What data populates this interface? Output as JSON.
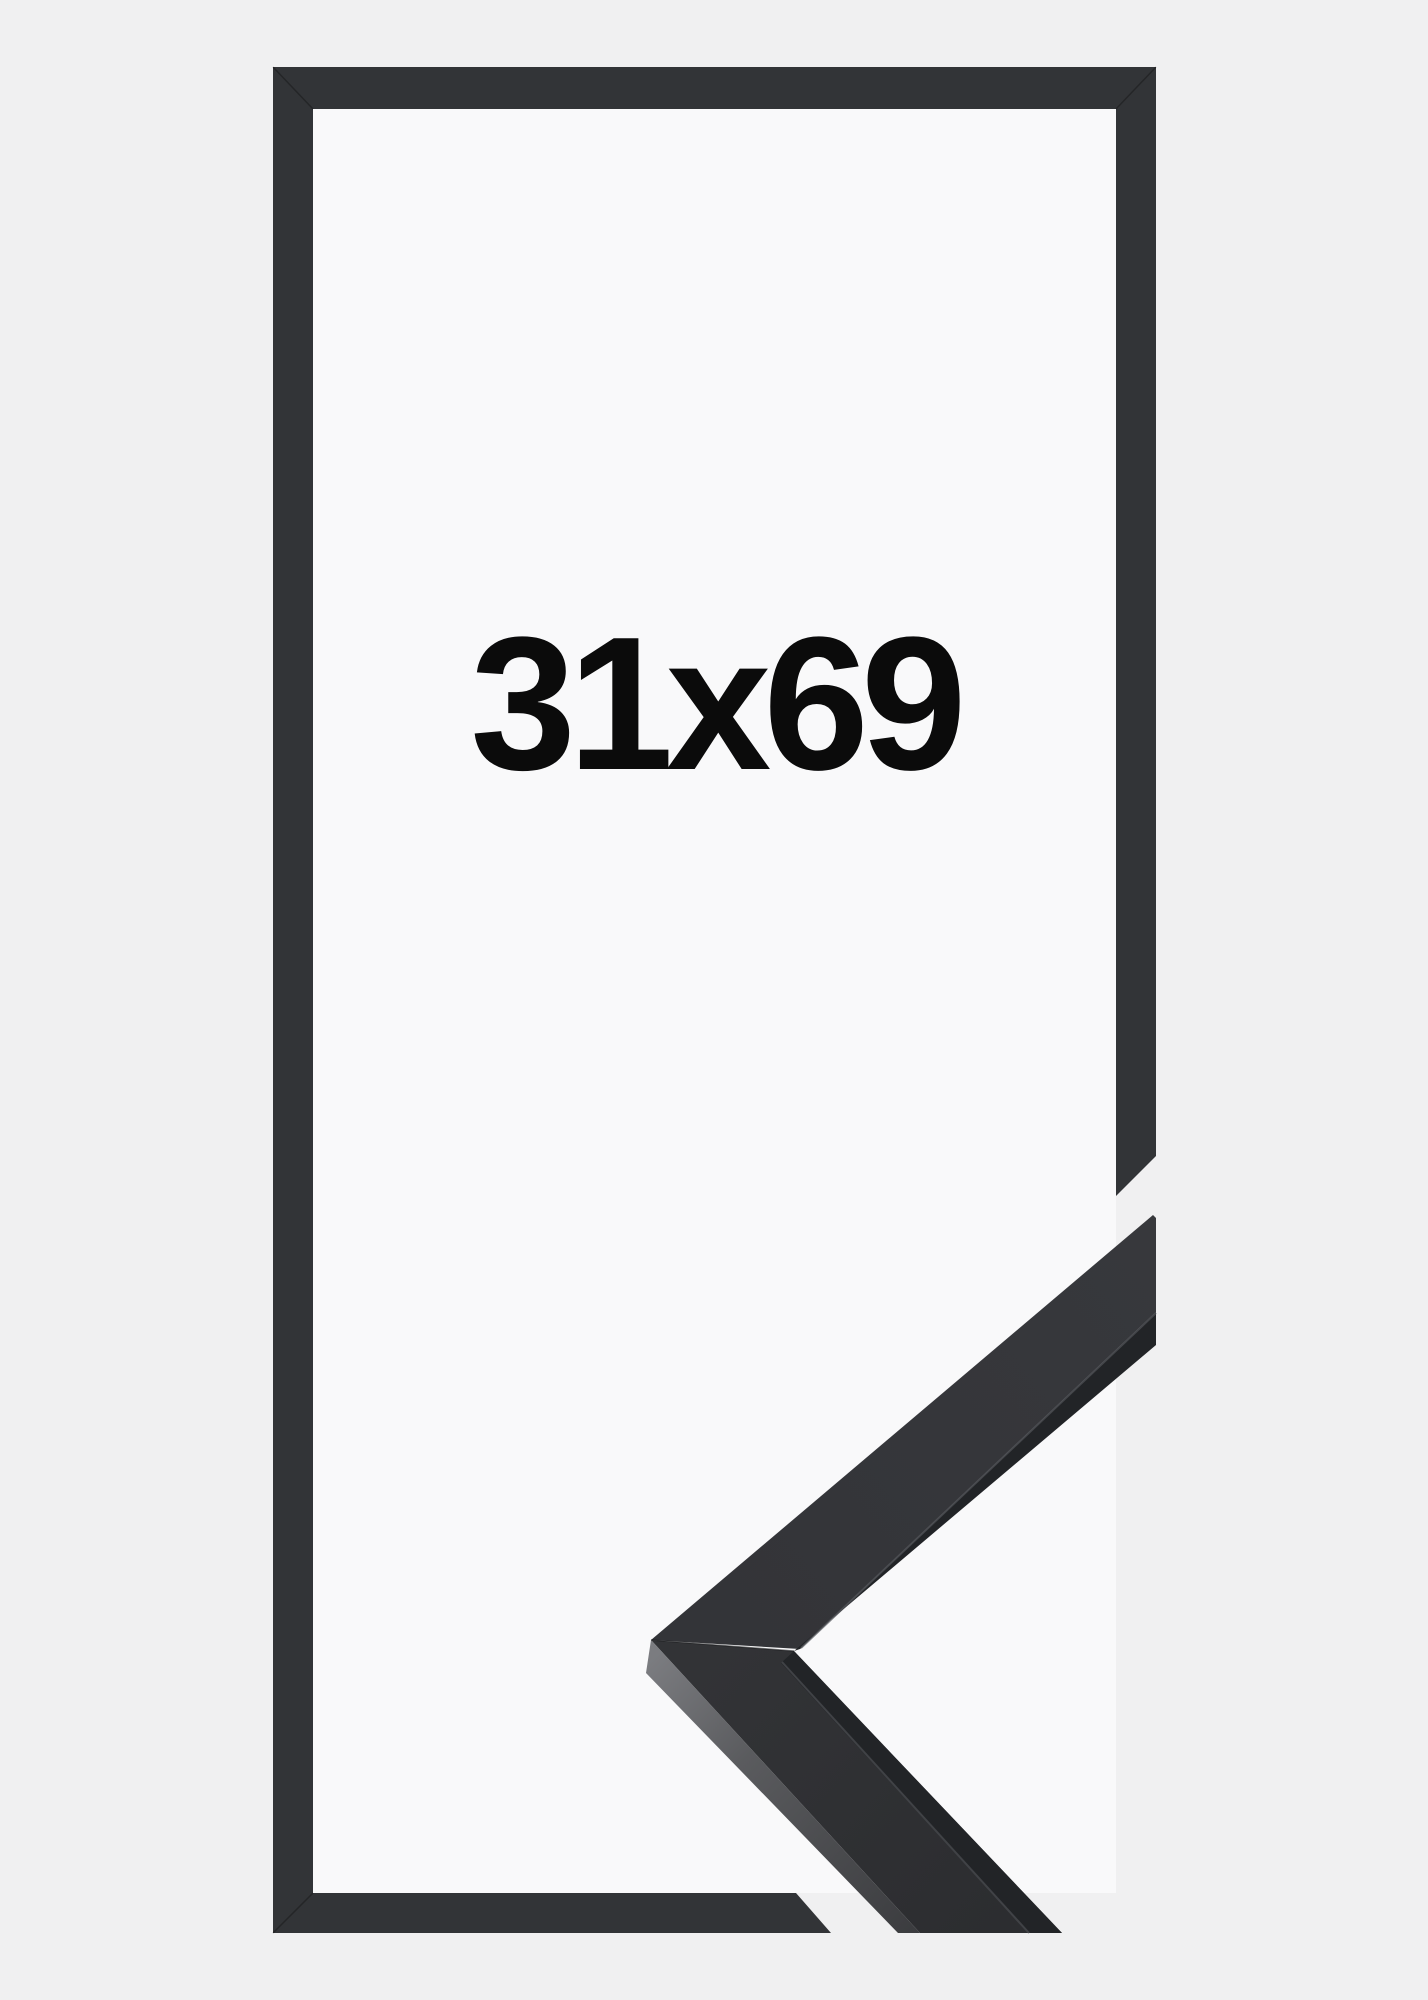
{
  "product_image": {
    "size_label": "31x69",
    "description_names": {
      "outline": "flat frame outline graphic",
      "corner_photo": "photographed frame corner sample",
      "label": "frame size in centimeters"
    },
    "colors": {
      "background": "#f0f0f1",
      "inner-background": "#f9f9fa",
      "frame-graphic": "#323437",
      "moulding-top-upper": "#343539",
      "moulding-top-lower": "#2f3033",
      "moulding-inner-lip": "#222427",
      "moulding-depth-light": "#7b7c80",
      "moulding-depth-dark": "#3a3b3e",
      "text": "#0b0b0b"
    }
  }
}
